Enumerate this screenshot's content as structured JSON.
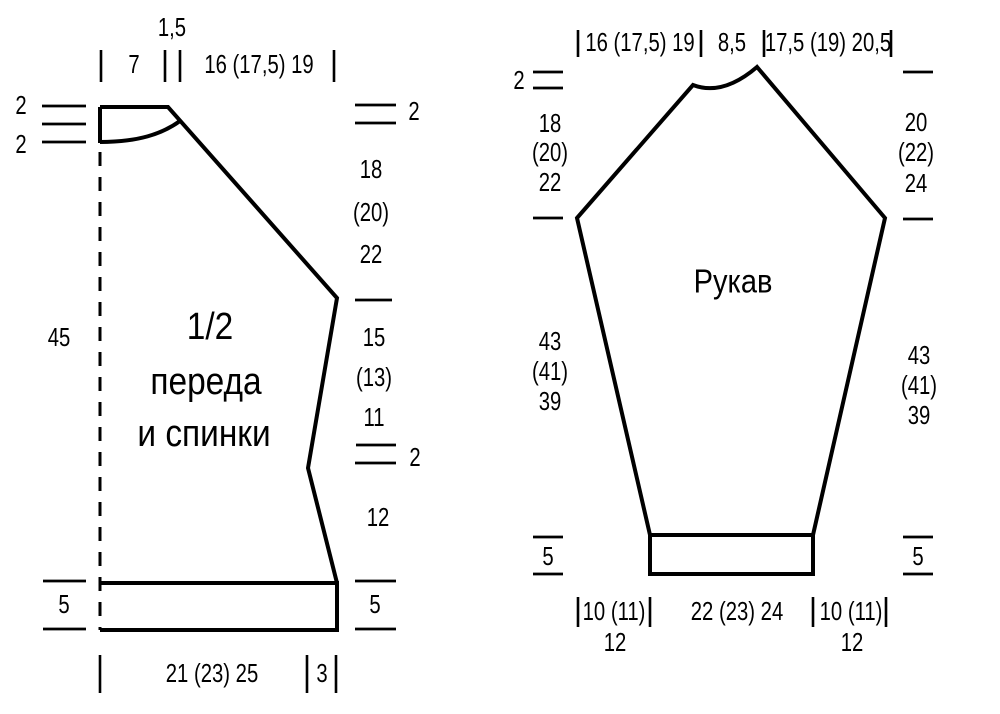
{
  "colors": {
    "ink": "#000000",
    "background": "#ffffff"
  },
  "front_back": {
    "title": [
      "1/2",
      "переда",
      "и спинки"
    ],
    "top": {
      "gap": "1,5",
      "shoulder_width": "7",
      "neck_width": "16 (17,5) 19"
    },
    "left": {
      "neck_drop_back": "2",
      "neck_drop_front": "2",
      "side_height": "45"
    },
    "right": {
      "shoulder_drop": "2",
      "raglan_height": [
        "18",
        "(20)",
        "22"
      ],
      "armhole_to_waist": [
        "15",
        "(13)",
        "11"
      ],
      "waist_shaping": "2",
      "hip_height": "12",
      "band_height": "5"
    },
    "bottom": {
      "band_height_left": "5",
      "half_width": "21 (23) 25",
      "side_extra": "3"
    }
  },
  "sleeve": {
    "title": "Рукав",
    "top": {
      "left_cap_width": "16 (17,5) 19",
      "top_width": "8,5",
      "right_cap_width": "17,5 (19) 20,5",
      "peak_drop": "2"
    },
    "left": {
      "cap_height": [
        "18",
        "(20)",
        "22"
      ],
      "seam_length": [
        "43",
        "(41)",
        "39"
      ],
      "cuff_height": "5"
    },
    "right": {
      "cap_height": [
        "20",
        "(22)",
        "24"
      ],
      "seam_length": [
        "43",
        "(41)",
        "39"
      ],
      "cuff_height": "5"
    },
    "bottom": {
      "left_taper": "10 (11)",
      "left_taper2": "12",
      "cuff_width": "22 (23) 24",
      "right_taper": "10 (11)",
      "right_taper2": "12"
    }
  }
}
